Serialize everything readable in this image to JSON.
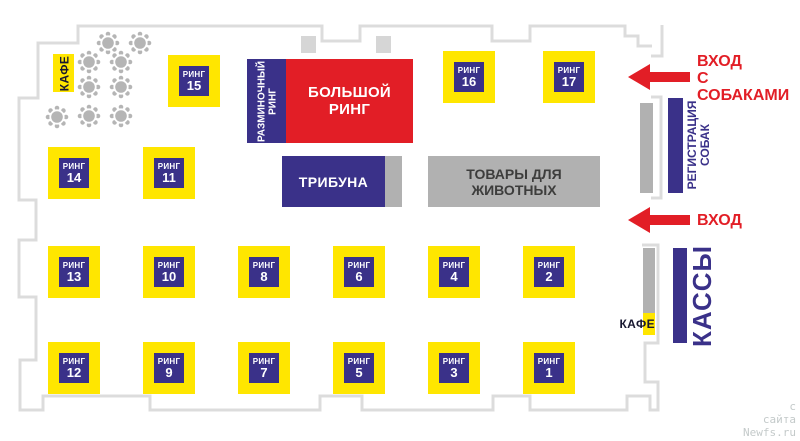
{
  "areas": {
    "cafe_top": "КАФЕ",
    "warmup_ring": "РАЗМИНОЧНЫЙ РИНГ",
    "big_ring": "БОЛЬШОЙ РИНГ",
    "tribune": "ТРИБУНА",
    "pet_goods": "ТОВАРЫ ДЛЯ ЖИВОТНЫХ",
    "registration": "РЕГИСТРАЦИЯ СОБАК",
    "cash": "КАССЫ",
    "cafe_bottom": "КАФЕ"
  },
  "rings": [
    {
      "label": "РИНГ",
      "number": "15"
    },
    {
      "label": "РИНГ",
      "number": "16"
    },
    {
      "label": "РИНГ",
      "number": "17"
    },
    {
      "label": "РИНГ",
      "number": "14"
    },
    {
      "label": "РИНГ",
      "number": "11"
    },
    {
      "label": "РИНГ",
      "number": "13"
    },
    {
      "label": "РИНГ",
      "number": "10"
    },
    {
      "label": "РИНГ",
      "number": "8"
    },
    {
      "label": "РИНГ",
      "number": "6"
    },
    {
      "label": "РИНГ",
      "number": "4"
    },
    {
      "label": "РИНГ",
      "number": "2"
    },
    {
      "label": "РИНГ",
      "number": "12"
    },
    {
      "label": "РИНГ",
      "number": "9"
    },
    {
      "label": "РИНГ",
      "number": "7"
    },
    {
      "label": "РИНГ",
      "number": "5"
    },
    {
      "label": "РИНГ",
      "number": "3"
    },
    {
      "label": "РИНГ",
      "number": "1"
    }
  ],
  "entrances": {
    "dogs_line1": "ВХОД",
    "dogs_line2": "С СОБАКАМИ",
    "main": "ВХОД"
  },
  "watermark": {
    "line1": "с",
    "line2": "сайта",
    "line3": "Newfs.ru"
  },
  "colors": {
    "yellow": "#ffe600",
    "navy": "#3a3189",
    "red": "#e21e26",
    "wall_gray": "#dcdcdc",
    "box_gray": "#b1b1b1",
    "dark_text": "#3d3d3c"
  }
}
